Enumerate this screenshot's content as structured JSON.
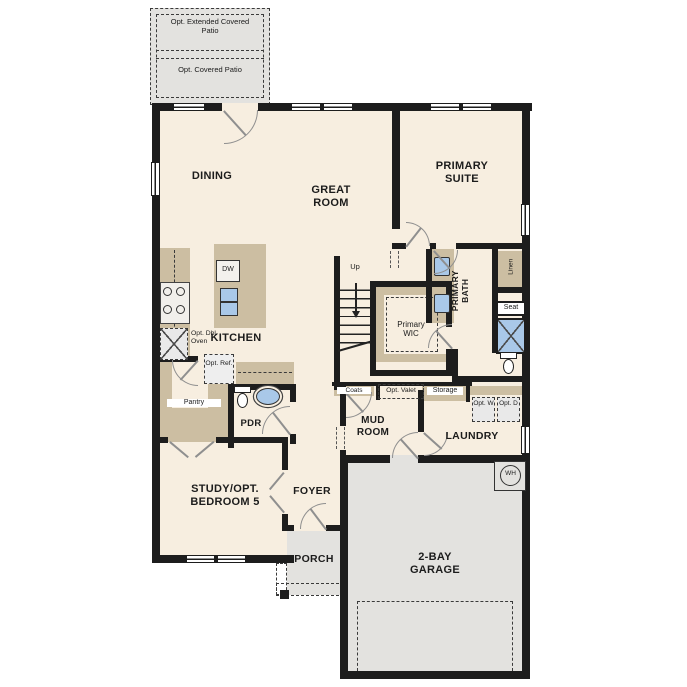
{
  "colors": {
    "wall": "#1d1d1d",
    "floor": "#f7eee0",
    "exterior_concrete": "#e3e2df",
    "cabinetry": "#ccbea2",
    "plumbing_fixture": "#a9c8e8"
  },
  "patio": {
    "extended_label": "Opt. Extended Covered Patio",
    "covered_label": "Opt. Covered Patio"
  },
  "rooms": {
    "dining": "DINING",
    "great_room": "GREAT ROOM",
    "primary_suite": "PRIMARY SUITE",
    "kitchen": "KITCHEN",
    "primary_wic": "Primary WIC",
    "primary_bath": "PRIMARY BATH",
    "pdr": "PDR",
    "pantry": "Pantry",
    "mud_room": "MUD ROOM",
    "laundry": "LAUNDRY",
    "study": "STUDY/OPT. BEDROOM 5",
    "foyer": "FOYER",
    "porch": "PORCH",
    "garage": "2-BAY GARAGE"
  },
  "features": {
    "up": "Up",
    "dishwasher": "DW",
    "opt_double_oven": "Opt. Dbl. Oven",
    "opt_refrigerator": "Opt. Ref.",
    "coats": "Coats",
    "opt_valet": "Opt. Valet",
    "storage": "Storage",
    "opt_washer": "Opt. W",
    "opt_dryer": "Opt. D",
    "linen": "Linen",
    "seat": "Seat",
    "water_heater": "WH"
  }
}
